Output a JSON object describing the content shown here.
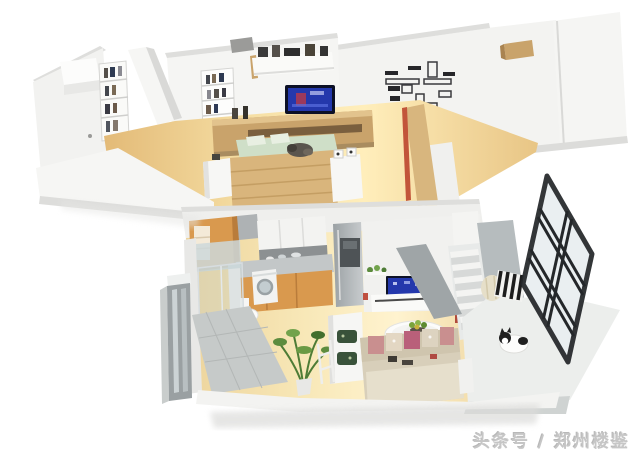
{
  "watermark": {
    "text": "头条号 / 郑州楼鉴"
  },
  "scene": {
    "description": "3D isometric cutaway render of a two-storey loft apartment floor plan",
    "floors": [
      {
        "id": "upper",
        "rooms": [
          "study",
          "bedroom",
          "hallway"
        ],
        "objects": [
          "white-table",
          "bookshelf",
          "recessed-shelf",
          "wall-shelves",
          "tv",
          "media-console",
          "double-bed",
          "cat-on-bed",
          "nightstands",
          "photo-frame-wall",
          "wardrobe-volumes",
          "stair-railing"
        ]
      },
      {
        "id": "lower",
        "rooms": [
          "entry",
          "bathroom",
          "kitchen",
          "living-dining",
          "stairs",
          "balcony"
        ],
        "objects": [
          "mirror-wardrobe",
          "washing-machine",
          "toilet",
          "glass-shower",
          "tall-cabinet",
          "upper-cabinets",
          "counter",
          "fridge",
          "tv",
          "tv-console",
          "round-dining-table",
          "fruit-plate",
          "sofa",
          "desk-with-green-chairs",
          "potted-plant",
          "striped-pouf",
          "cat",
          "black-frame-glass-window",
          "stairs"
        ]
      }
    ]
  },
  "colors": {
    "background": "#ffffff",
    "wall-white": "#f3f3f1",
    "wall-shadow": "#dededc",
    "wood-floor": "#f2ddab",
    "wood-furniture": "#c9a36b",
    "wood-bed": "#d9b57c",
    "cabinet-orange": "#d9994e",
    "mint-bedding": "#cfdfc8",
    "tv-screen-blue": "#2438ac",
    "stair-gray": "#9fa5a7",
    "window-frame-black": "#24272a",
    "glass-blue": "#e9eef1",
    "sofa-beige": "#d8cfba",
    "plant-green": "#5d8c3e",
    "accent-red": "#c2553a",
    "watermark-gray": "#c3c3c3"
  }
}
